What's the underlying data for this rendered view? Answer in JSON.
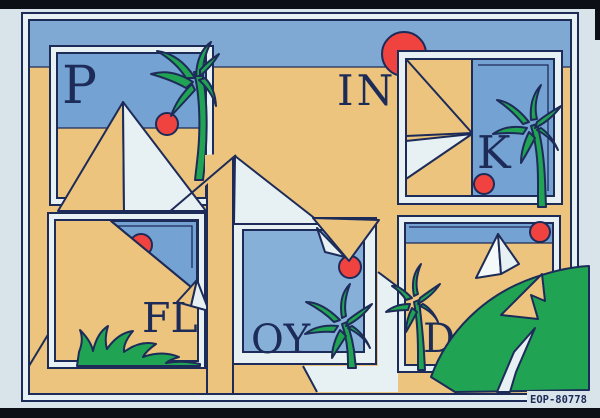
{
  "photo": {
    "code_label": "EOP-80778"
  },
  "letters": {
    "p": "P",
    "in": "IN",
    "k": "K",
    "fl": "FL",
    "oy": "OY",
    "d": "D"
  },
  "palette": {
    "margin": "#d8e4e9",
    "photo_edge": "#0d0f16",
    "line": "#1d2b58",
    "sand": "#ecc47d",
    "sky": "#7fa9d3",
    "panel_sky": "#74a2d2",
    "panel_sky_light": "#86b0d8",
    "light": "#e7f0f2",
    "bright": "#f4f9f9",
    "red": "#f04340",
    "green": "#21a354"
  }
}
